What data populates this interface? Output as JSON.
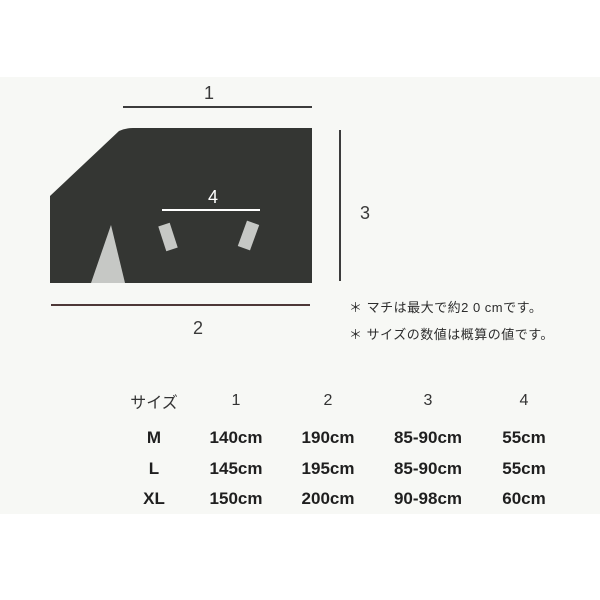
{
  "diagram": {
    "label_top_width": "1",
    "label_bottom_width": "2",
    "label_height": "3",
    "label_inner_width": "4"
  },
  "notes": [
    "＊ マチは最大で約2 0 cmです。",
    "＊ サイズの数値は概算の値です。"
  ],
  "size_table": {
    "headers": [
      "サイズ",
      "1",
      "2",
      "3",
      "4"
    ],
    "rows": [
      {
        "size": "M",
        "values": [
          "140cm",
          "190cm",
          "85-90cm",
          "55cm"
        ]
      },
      {
        "size": "L",
        "values": [
          "145cm",
          "195cm",
          "85-90cm",
          "55cm"
        ]
      },
      {
        "size": "XL",
        "values": [
          "150cm",
          "200cm",
          "90-98cm",
          "60cm"
        ]
      }
    ]
  },
  "colors": {
    "garment_fill": "#343633",
    "inner_detail_fill": "#c6c8c5",
    "measure_line": "#3c3c3c",
    "bottom_measure_line": "#4e3838",
    "content_background": "#f7f8f5",
    "inner_measure_line": "#ffffff"
  }
}
